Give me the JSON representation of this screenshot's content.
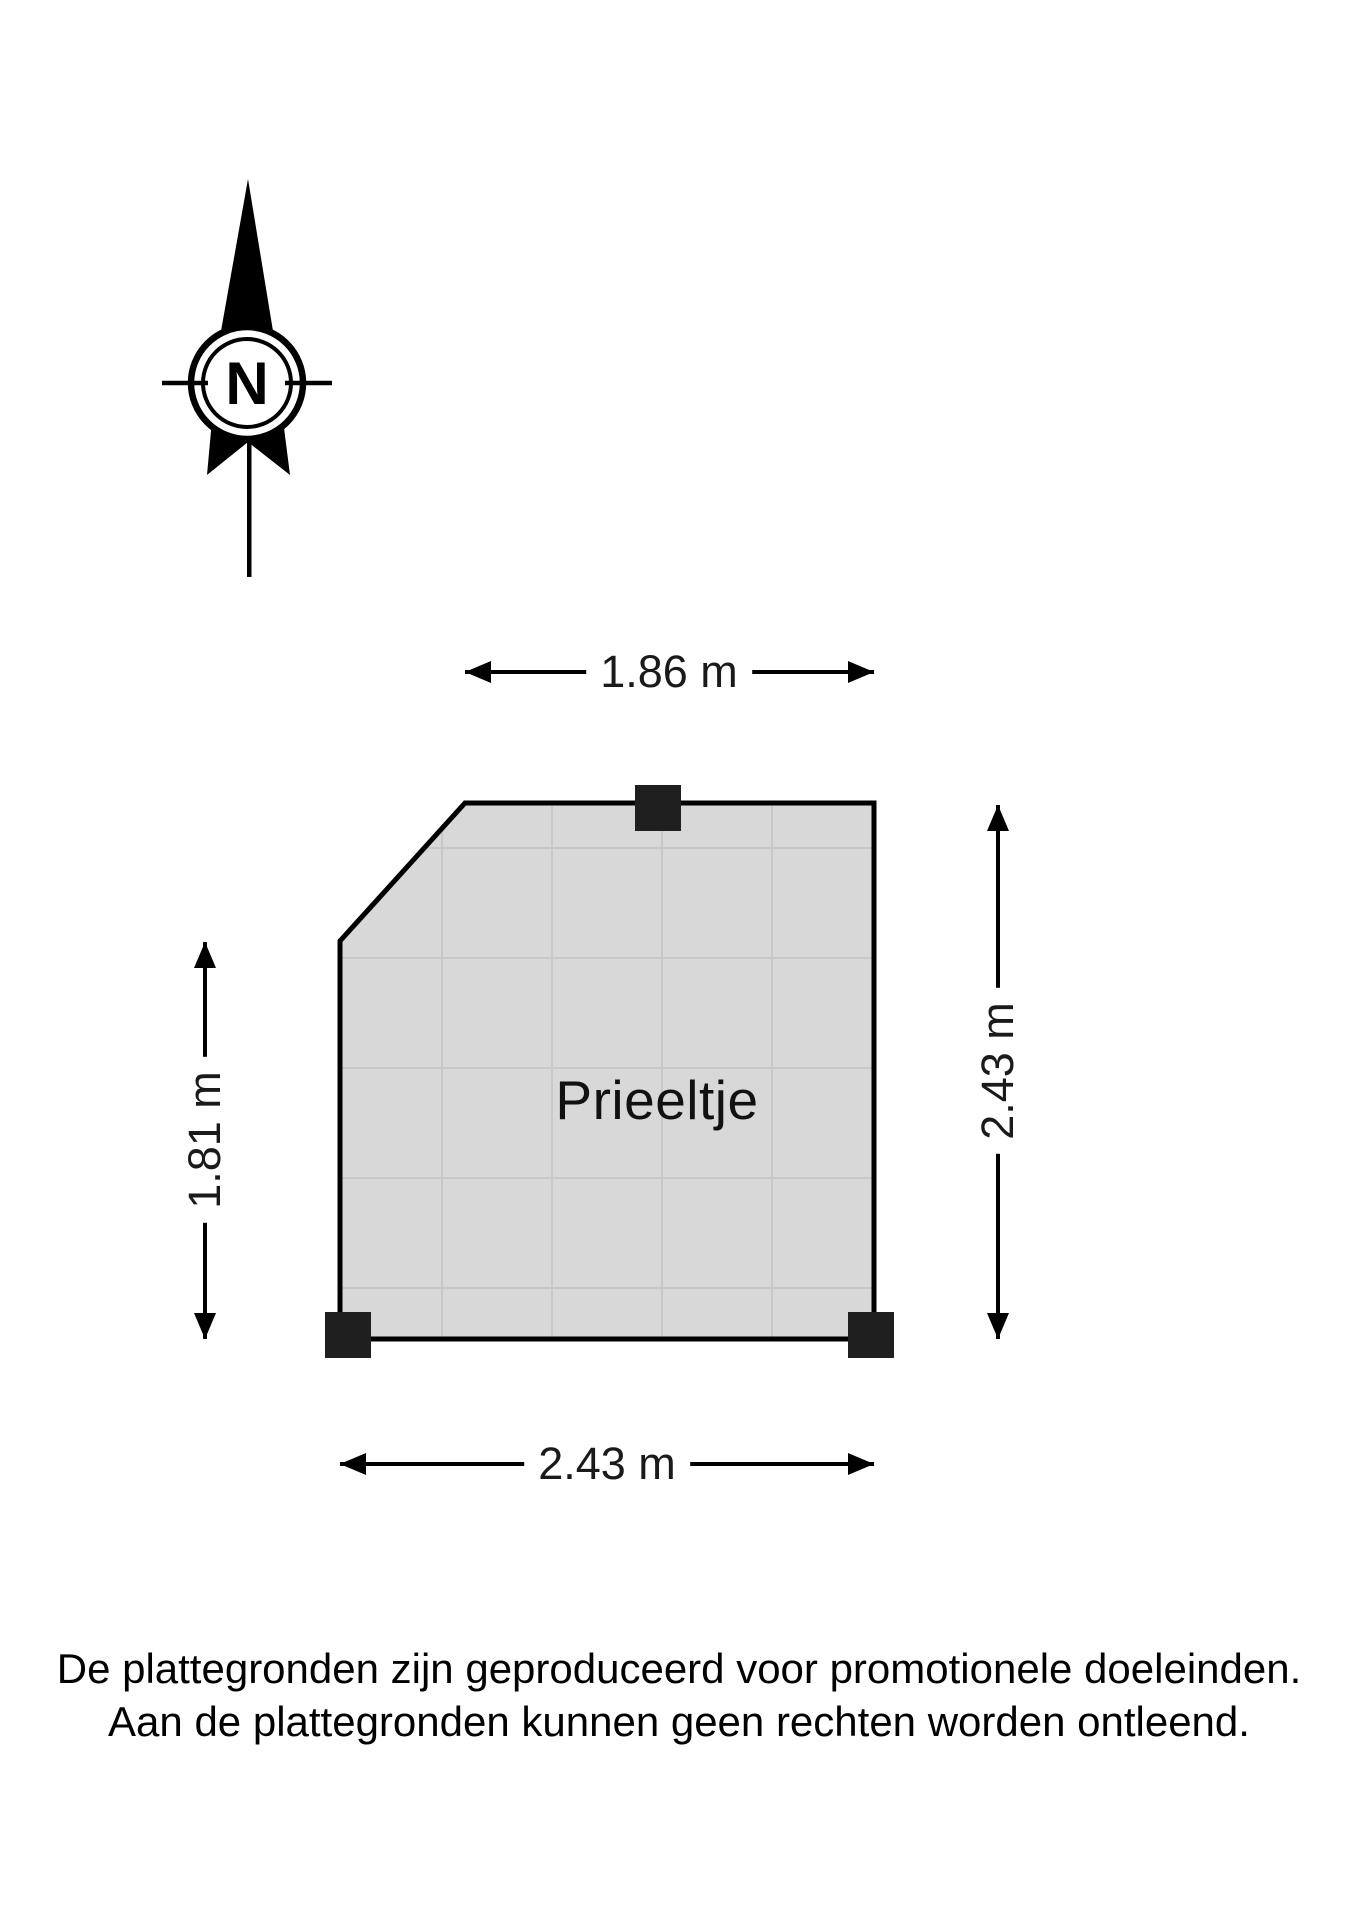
{
  "page": {
    "type": "floorplan-diagram",
    "background_color": "#ffffff"
  },
  "compass": {
    "label": "N"
  },
  "plan": {
    "room_label": "Prieeltje",
    "fill_color": "#d8d8d8",
    "grid_color": "#c8c8c8",
    "outline_color": "#000000",
    "post_color": "#1f1f1f"
  },
  "dimensions": {
    "top": "1.86 m",
    "left": "1.81 m",
    "right": "2.43 m",
    "bottom": "2.43 m"
  },
  "disclaimer": {
    "line1": "De plattegronden zijn geproduceerd voor promotionele doeleinden.",
    "line2": "Aan de plattegronden kunnen geen rechten worden ontleend."
  }
}
